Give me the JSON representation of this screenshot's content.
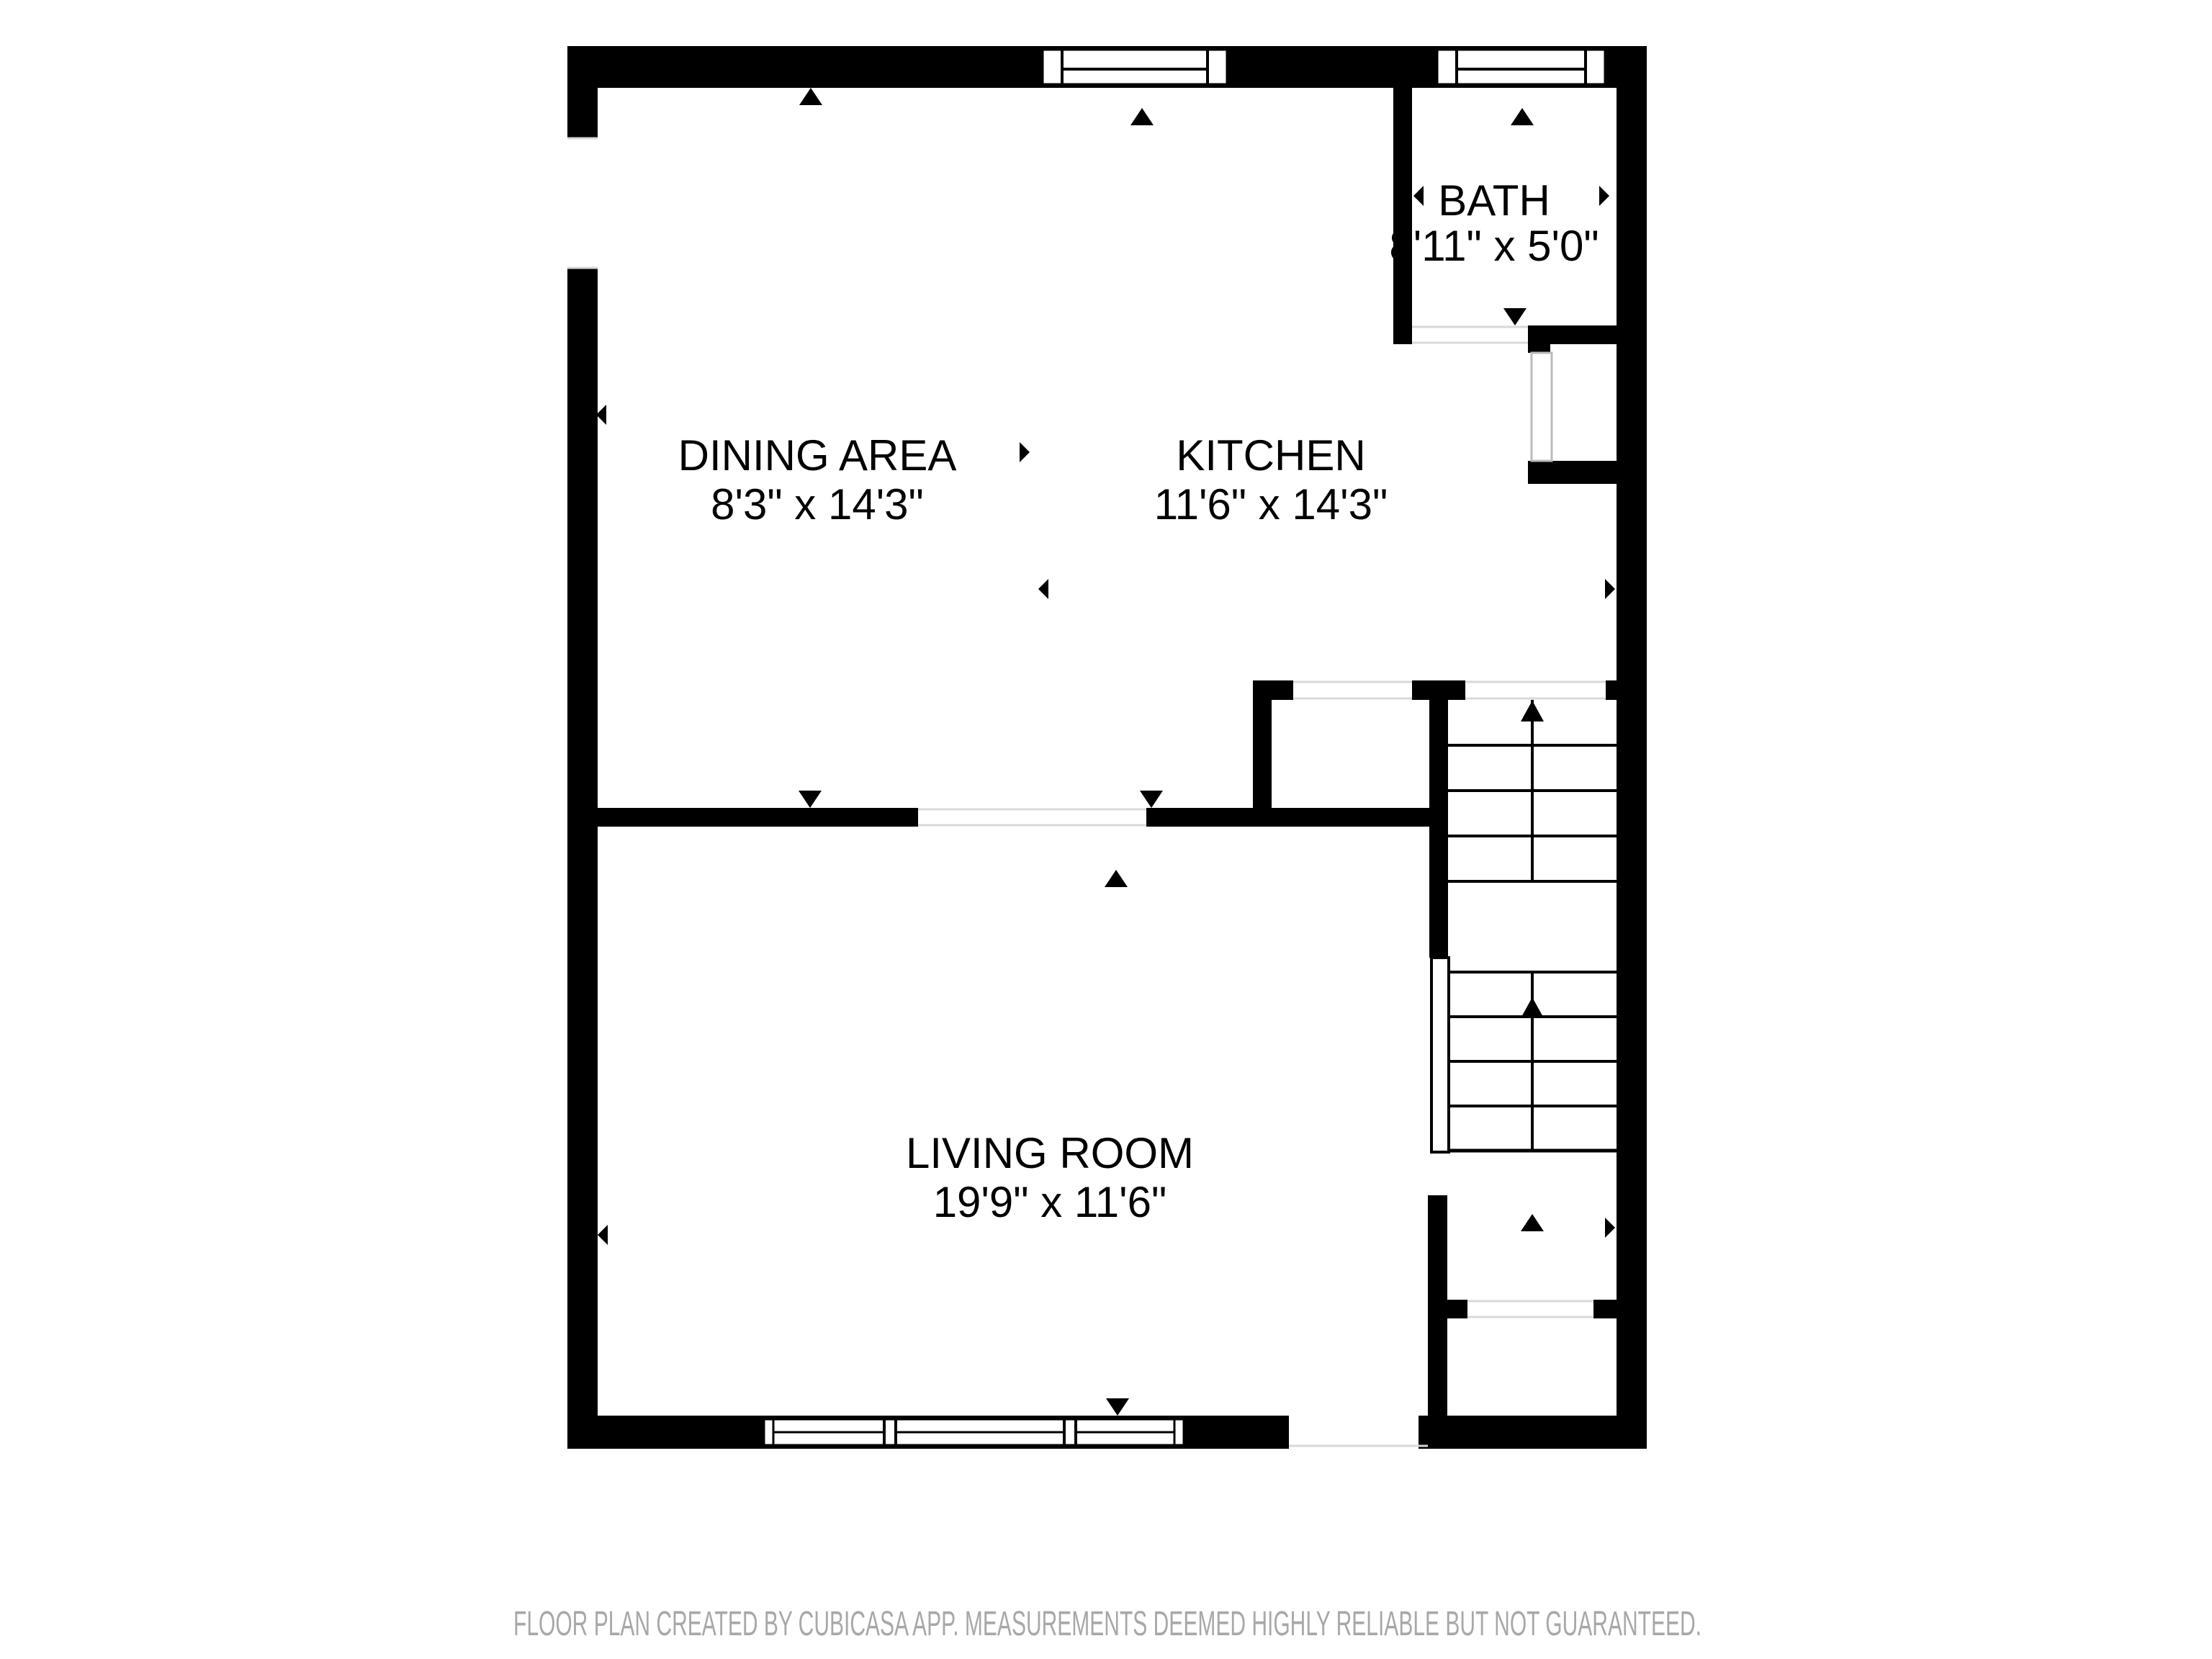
{
  "floor_plan": {
    "rooms": {
      "dining": {
        "name": "DINING AREA",
        "dims": "8'3\" x 14'3\""
      },
      "kitchen": {
        "name": "KITCHEN",
        "dims": "11'6\" x 14'3\""
      },
      "bath": {
        "name": "BATH",
        "dims": "8'11\" x 5'0\""
      },
      "living": {
        "name": "LIVING ROOM",
        "dims": "19'9\" x 11'6\""
      }
    },
    "stairs": {
      "direction": "up",
      "flights": 2
    },
    "footer": "FLOOR PLAN CREATED BY CUBICASA APP. MEASUREMENTS DEEMED HIGHLY RELIABLE BUT NOT GUARANTEED.",
    "icons": {
      "stairs-up-arrow": "▲",
      "door-swing-marker": "▼",
      "extent-marker-up": "▲",
      "extent-marker-down": "▼",
      "extent-marker-left": "◀",
      "extent-marker-right": "▶"
    },
    "colors": {
      "wall": "#000000",
      "floor": "#ffffff",
      "room_text": "#000000",
      "footer_text": "#a8a8a8",
      "opening_edge": "#d8d8d8"
    }
  }
}
